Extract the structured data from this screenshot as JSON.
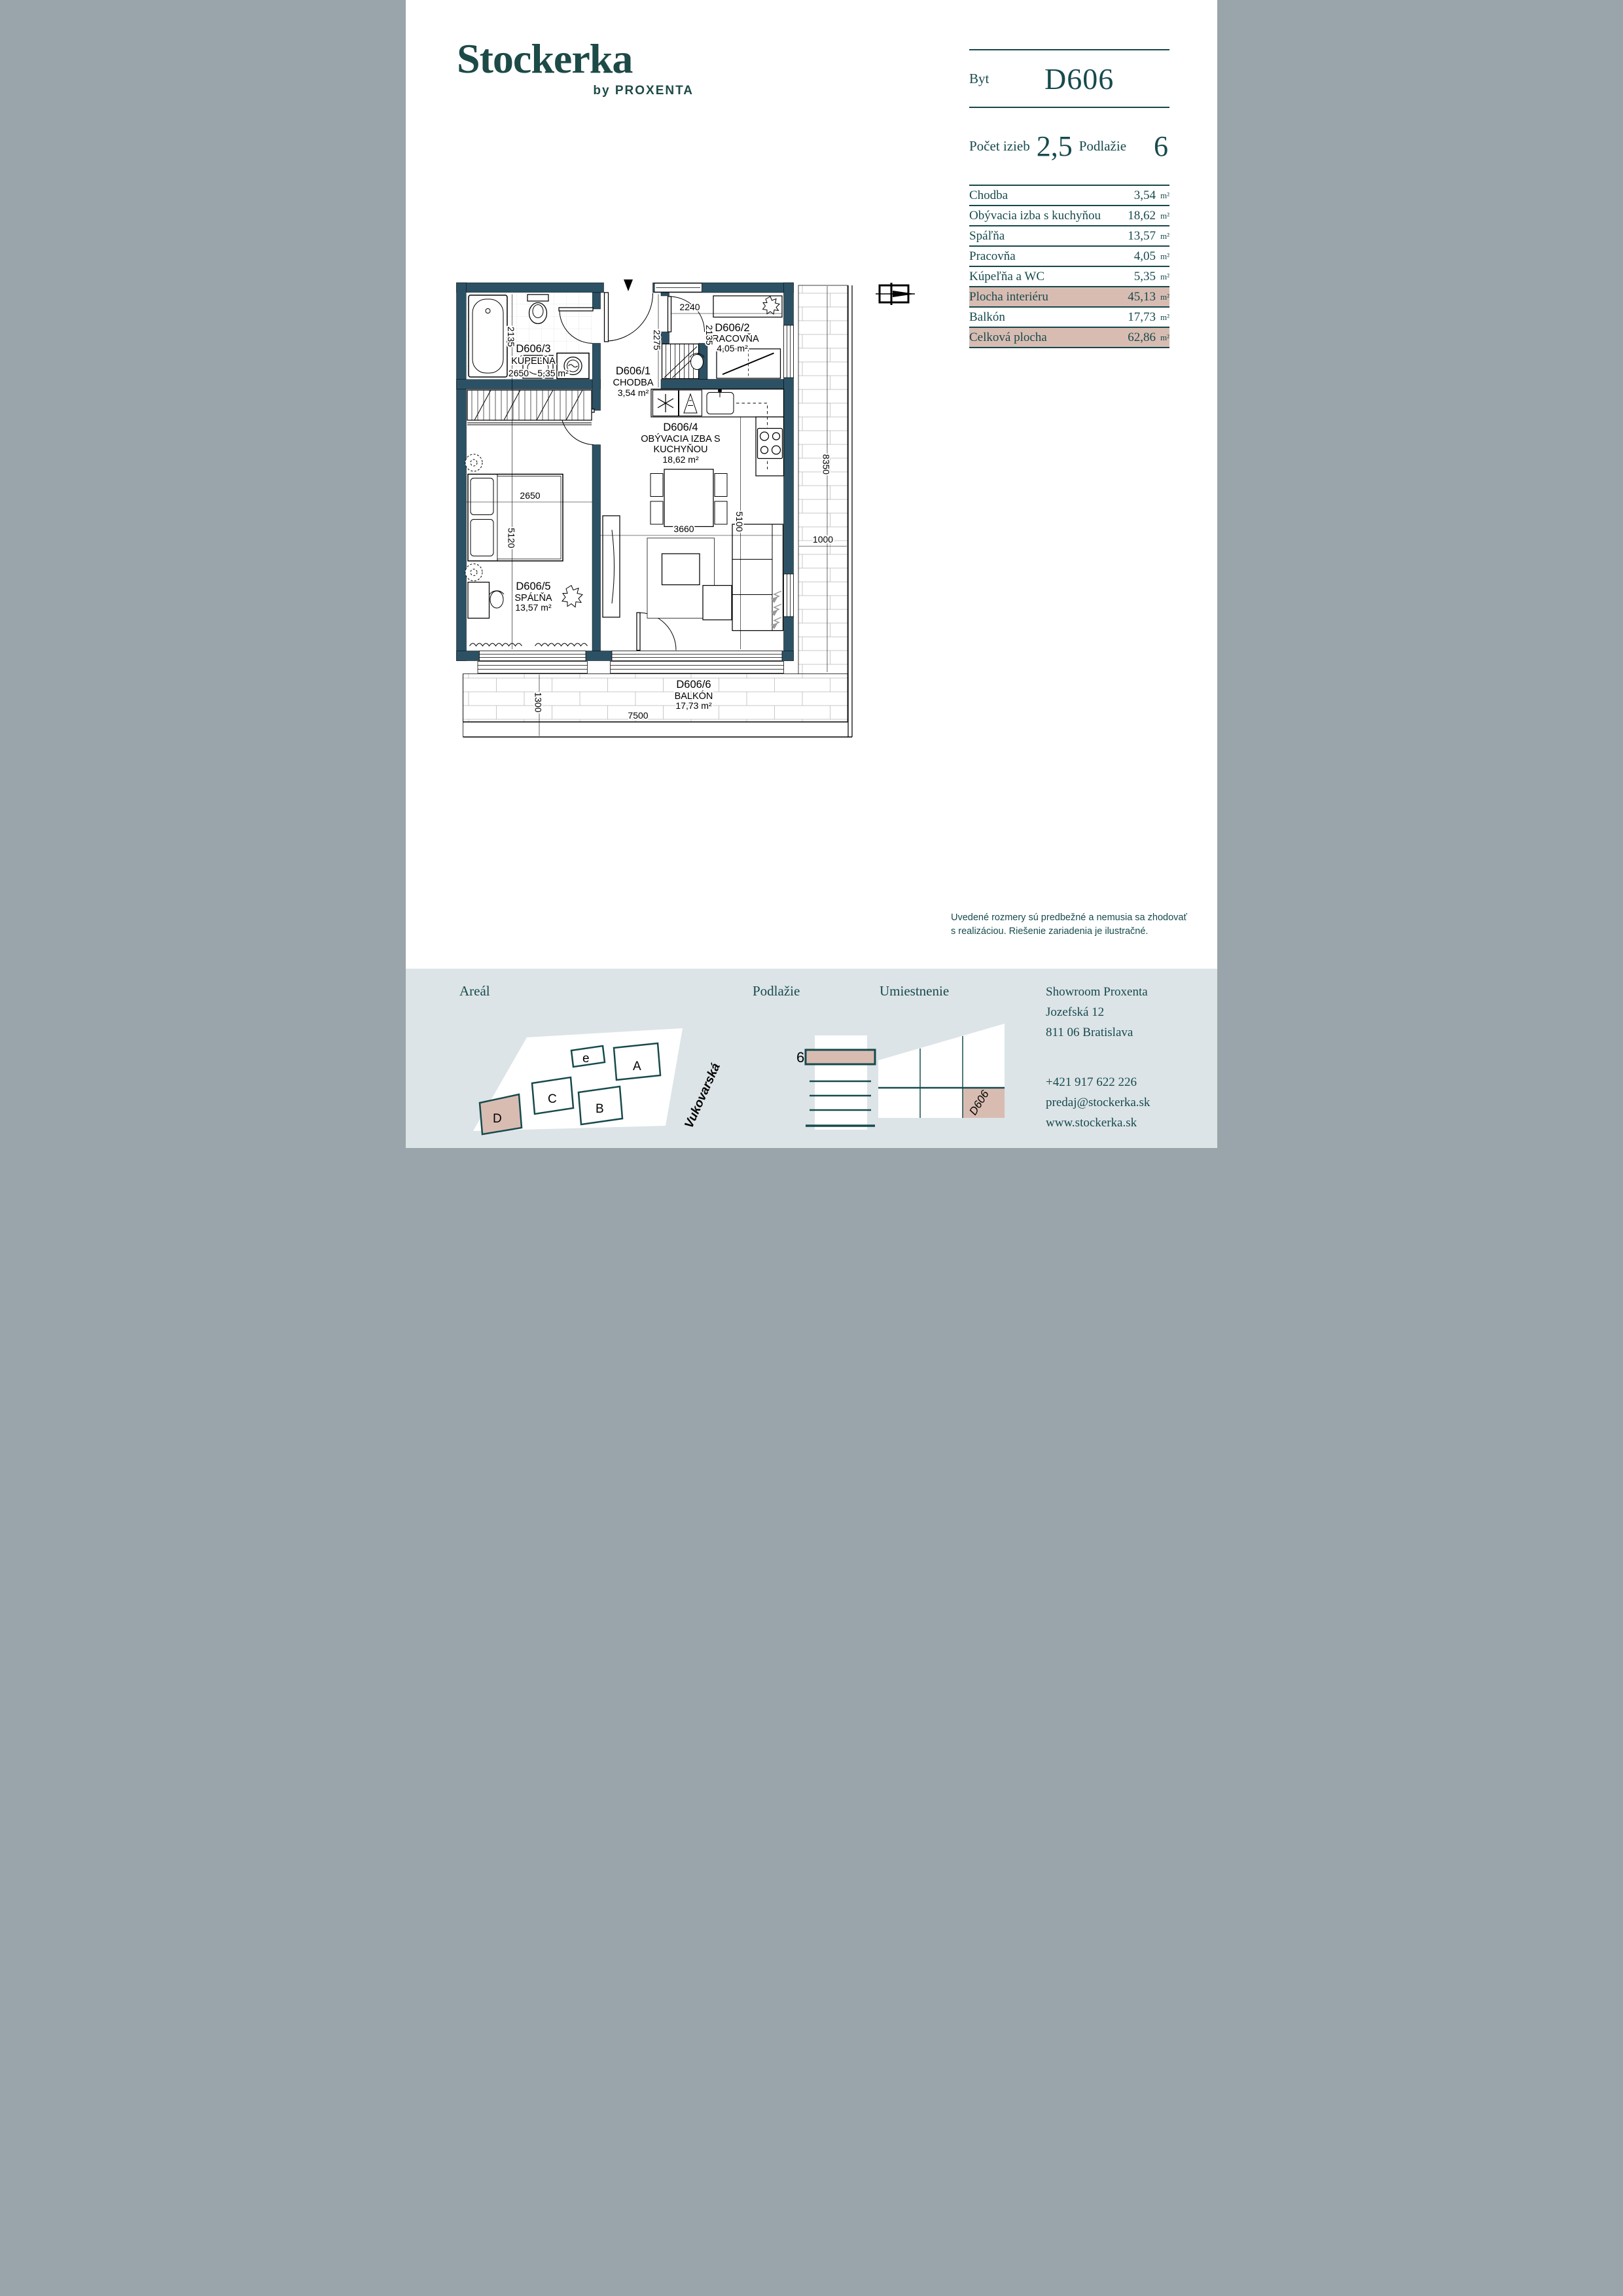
{
  "logo": {
    "brand": "Stockerka",
    "byline": "by PROXENTA"
  },
  "summary": {
    "byt_label": "Byt",
    "unit_id": "D606",
    "rooms_label": "Počet izieb",
    "rooms_value": "2,5",
    "floor_label": "Podlažie",
    "floor_value": "6"
  },
  "area_table": {
    "unit": "m²",
    "rows": [
      {
        "label": "Chodba",
        "value": "3,54",
        "highlight": false
      },
      {
        "label": "Obývacia izba s kuchyňou",
        "value": "18,62",
        "highlight": false
      },
      {
        "label": "Spáľňa",
        "value": "13,57",
        "highlight": false
      },
      {
        "label": "Pracovňa",
        "value": "4,05",
        "highlight": false
      },
      {
        "label": "Kúpeľňa a WC",
        "value": "5,35",
        "highlight": false
      },
      {
        "label": "Plocha interiéru",
        "value": "45,13",
        "highlight": true
      },
      {
        "label": "Balkón",
        "value": "17,73",
        "highlight": false
      },
      {
        "label": "Celková plocha",
        "value": "62,86",
        "highlight": true
      }
    ]
  },
  "floor_plan": {
    "rooms": {
      "hall": {
        "id": "D606/1",
        "name": "CHODBA",
        "area": "3,54 m²"
      },
      "office": {
        "id": "D606/2",
        "name": "PRACOVŇA",
        "area": "4,05 m²"
      },
      "bath": {
        "id": "D606/3",
        "name": "KÚPEĽŇA",
        "area": "5,35 m²"
      },
      "living": {
        "id": "D606/4",
        "name_line1": "OBÝVACIA IZBA S",
        "name_line2": "KUCHYŇOU",
        "area": "18,62 m²"
      },
      "bedroom": {
        "id": "D606/5",
        "name": "SPÁĽŇA",
        "area": "13,57 m²"
      },
      "balcony": {
        "id": "D606/6",
        "name": "BALKÓN",
        "area": "17,73 m²"
      }
    },
    "dims": {
      "bath_depth": "2135",
      "bath_width": "2650",
      "hall_height": "2275",
      "office_width": "2240",
      "office_depth": "2135",
      "living_width": "3660",
      "living_height": "5100",
      "bed_width": "2650",
      "bed_height": "5120",
      "balcony_side_height": "8350",
      "balcony_side_width": "1000",
      "balcony_bottom_depth": "1300",
      "balcony_bottom_width": "7500"
    }
  },
  "disclaimer": {
    "line1": "Uvedené rozmery sú predbežné a nemusia sa zhodovať",
    "line2": "s realizáciou. Riešenie zariadenia je ilustračné."
  },
  "footer": {
    "site": {
      "label": "Areál",
      "buildings": [
        "e",
        "A",
        "C",
        "B",
        "D"
      ],
      "highlighted_building": "D",
      "street": "Vukovarská"
    },
    "floor": {
      "label": "Podlažie",
      "number": "6"
    },
    "location": {
      "label": "Umiestnenie",
      "unit_tag": "D606"
    },
    "contact": {
      "name": "Showroom Proxenta",
      "address1": "Jozefská 12",
      "address2": "811 06 Bratislava",
      "phone": "+421 917 622 226",
      "email": "predaj@stockerka.sk",
      "web": "www.stockerka.sk"
    }
  },
  "colors": {
    "wall": "#2d5164",
    "text": "#174a4d",
    "highlight": "#d8bcb2",
    "footer_bg": "#dce4e7",
    "logo": "#1d4a47"
  }
}
